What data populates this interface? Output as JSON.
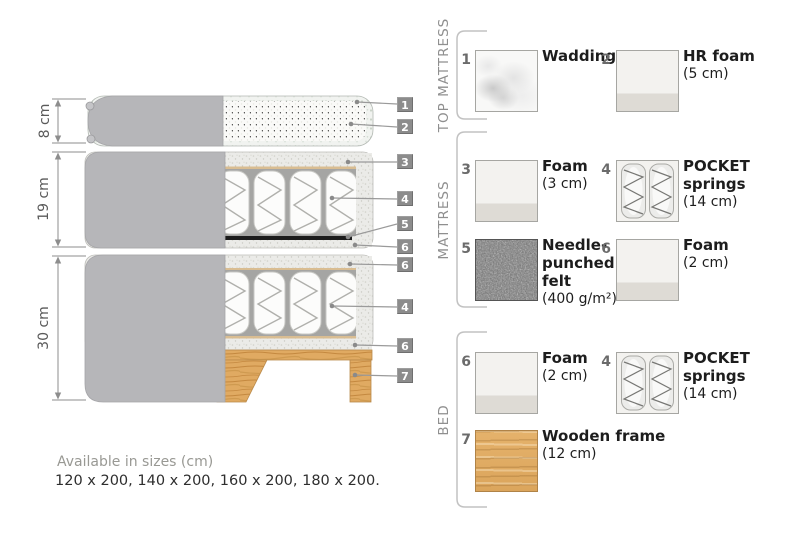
{
  "diagram": {
    "dimensions": [
      {
        "label": "8 cm"
      },
      {
        "label": "19 cm"
      },
      {
        "label": "30 cm"
      }
    ],
    "callouts": [
      "1",
      "2",
      "3",
      "4",
      "5",
      "6",
      "6",
      "4",
      "6",
      "7"
    ]
  },
  "legend": {
    "sections": [
      {
        "title": "TOP MATTRESS",
        "items": [
          {
            "num": "1",
            "name": "Wadding",
            "size": "",
            "texture": "wadding"
          },
          {
            "num": "2",
            "name": "HR foam",
            "size": "(5 cm)",
            "texture": "foam"
          }
        ]
      },
      {
        "title": "MATTRESS",
        "items": [
          {
            "num": "3",
            "name": "Foam",
            "size": "(3 cm)",
            "texture": "foam"
          },
          {
            "num": "4",
            "name": "POCKET springs",
            "size": "(14 cm)",
            "texture": "pocket-springs"
          },
          {
            "num": "5",
            "name": "Needle-punched felt",
            "size": "(400 g/m²)",
            "texture": "felt"
          },
          {
            "num": "6",
            "name": "Foam",
            "size": "(2 cm)",
            "texture": "foam"
          }
        ]
      },
      {
        "title": "BED",
        "items": [
          {
            "num": "6",
            "name": "Foam",
            "size": "(2 cm)",
            "texture": "foam"
          },
          {
            "num": "4",
            "name": "POCKET springs",
            "size": "(14 cm)",
            "texture": "pocket-springs"
          },
          {
            "num": "7",
            "name": "Wooden frame",
            "size": "(12 cm)",
            "texture": "wood"
          }
        ]
      }
    ]
  },
  "footer": {
    "sizes_label": "Available in sizes (cm)",
    "sizes": "120 x 200, 140 x 200, 160 x 200, 180 x 200."
  },
  "colors": {
    "cover_gray": "#b6b6b9",
    "wood": "#e0aa62",
    "callout_bg": "#8c8c8c",
    "felt_line_black": "#1c1c1c",
    "text_dark": "#1d1d1d",
    "text_gray": "#8f8f8f"
  }
}
